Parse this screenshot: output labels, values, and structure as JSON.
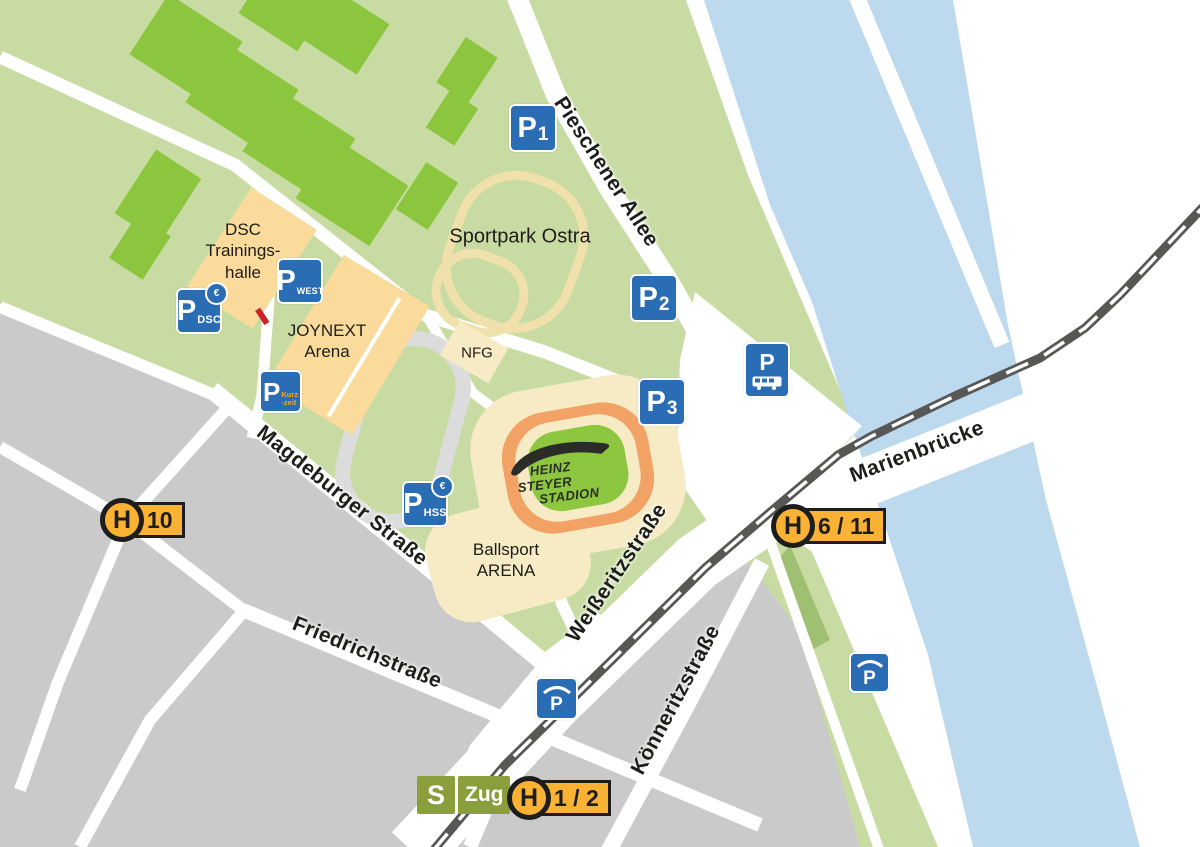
{
  "colors": {
    "land_green": "#c8dba2",
    "field_green": "#8cc63e",
    "building_beige": "#fbdb9b",
    "plot_cream": "#f6ebc4",
    "track_cream": "#f0e0ac",
    "track_gray": "#dcdcdc",
    "stadium_orange": "#f2a264",
    "pitch_green": "#8dc63f",
    "urban_gray": "#cacaca",
    "river_blue": "#bdd9ee",
    "parking_blue": "#2a6db4",
    "tram_yellow": "#f9b233",
    "sbahn_green": "#8b9e3c",
    "railway_gray": "#575756",
    "road_white": "#ffffff",
    "text_dark": "#1d1d1b",
    "closure_red": "#c9242b",
    "kurzzeit_orange": "#f7a823"
  },
  "streets": {
    "pieschener_allee": "Pieschener Allee",
    "magdeburger": "Magdeburger Straße",
    "friedrichstrasse": "Friedrichstraße",
    "weisseritzstrasse": "Weißeritzstraße",
    "koenneritzstrasse": "Könneritzstraße",
    "marienbruecke": "Marienbrücke"
  },
  "areas": {
    "sportpark": "Sportpark Ostra",
    "dsc": {
      "line1": "DSC",
      "line2": "Trainings-",
      "line3": "halle"
    },
    "joynext": {
      "line1": "JOYNEXT",
      "line2": "Arena"
    },
    "nfg": "NFG",
    "ballsport": {
      "line1": "Ballsport",
      "line2": "ARENA"
    }
  },
  "stadium": {
    "line1": "HEINZ",
    "line2": "STEYER",
    "line3": "STADION"
  },
  "parking": {
    "p_letter": "P",
    "euro": "€",
    "p1_sub": "1",
    "p2_sub": "2",
    "p3_sub": "3",
    "west_sub": "WEST",
    "dsc_sub": "DSC",
    "kurz_sub_line1": "Kurz",
    "kurz_sub_line2": "-zeit",
    "hss_sub": "HSS"
  },
  "transit": {
    "h_letter": "H",
    "stop_10": "10",
    "stop_6_11": "6 / 11",
    "stop_1_2": "1 / 2",
    "s_letter": "S",
    "zug_label": "Zug"
  }
}
